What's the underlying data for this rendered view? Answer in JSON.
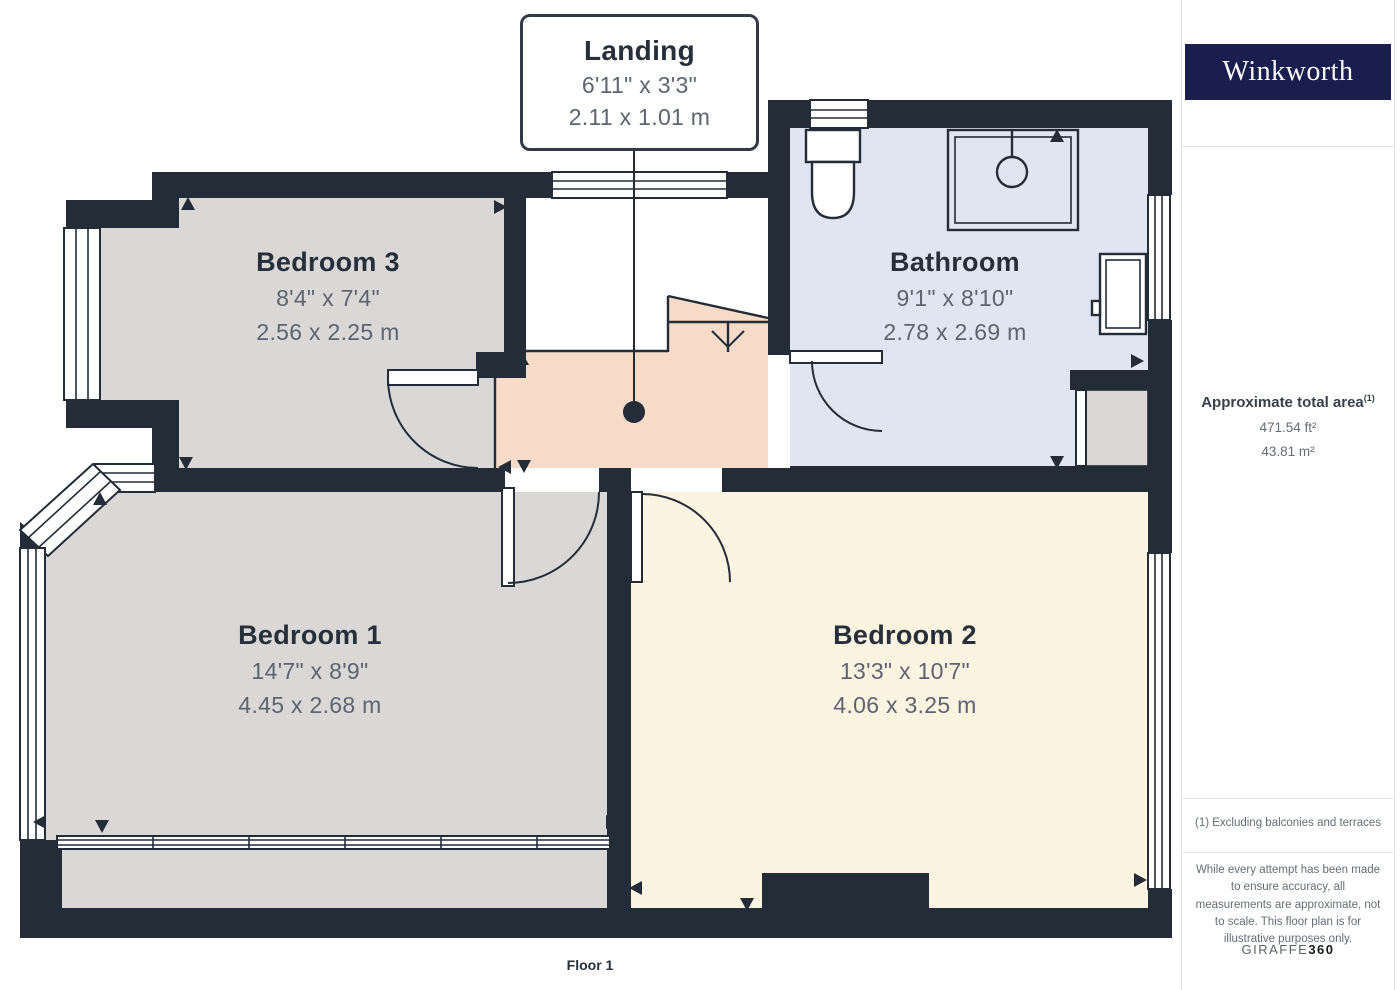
{
  "floorplan": {
    "floor_label": "Floor 1",
    "callout": {
      "name": "Landing",
      "dims_ft": "6'11\" x 3'3\"",
      "dims_m": "2.11 x 1.01 m"
    },
    "rooms": [
      {
        "id": "bedroom-3",
        "name": "Bedroom 3",
        "dims_ft": "8'4\" x 7'4\"",
        "dims_m": "2.56 x 2.25 m"
      },
      {
        "id": "bathroom",
        "name": "Bathroom",
        "dims_ft": "9'1\" x 8'10\"",
        "dims_m": "2.78 x 2.69 m"
      },
      {
        "id": "bedroom-1",
        "name": "Bedroom 1",
        "dims_ft": "14'7\" x 8'9\"",
        "dims_m": "4.45 x 2.68 m"
      },
      {
        "id": "bedroom-2",
        "name": "Bedroom 2",
        "dims_ft": "13'3\" x 10'7\"",
        "dims_m": "4.06 x 3.25 m"
      }
    ],
    "stairs_direction": "down"
  },
  "sidebar": {
    "brand": "Winkworth",
    "area_title": "Approximate total area",
    "area_superscript": "(1)",
    "area_ft": "471.54 ft²",
    "area_m": "43.81 m²",
    "footnote": "(1) Excluding balconies and terraces",
    "disclaimer": "While every attempt has been made to ensure accuracy, all measurements are approximate, not to scale. This floor plan is for illustrative purposes only.",
    "brand_footer": {
      "normal": "GIRAFFE",
      "bold": "360"
    }
  },
  "colors": {
    "wall": "#242c38",
    "bedroom_floor": "#d9d8d6",
    "bathroom_floor": "#e0e5f2",
    "landing_floor": "#f6dbc9",
    "bedroom2_floor": "#fcf3e1",
    "brand_navy": "#1a1e4e",
    "room_name": "#272f3b",
    "dims_text": "#5d6470"
  }
}
